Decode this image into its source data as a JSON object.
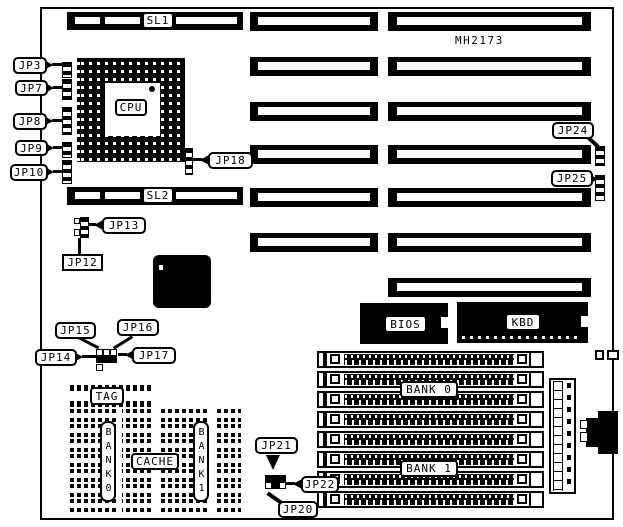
{
  "board": {
    "model": "MH2173"
  },
  "slots": {
    "sl1": "SL1",
    "sl2": "SL2"
  },
  "cpu": {
    "label": "CPU"
  },
  "chips": {
    "bios": "BIOS",
    "kbd": "KBD"
  },
  "cache": {
    "tag": "TAG",
    "cache": "CACHE",
    "bank0": "BANK0",
    "bank1": "BANK1"
  },
  "memory": {
    "bank0": "BANK 0",
    "bank1": "BANK 1"
  },
  "jumpers": {
    "jp3": "JP3",
    "jp7": "JP7",
    "jp8": "JP8",
    "jp9": "JP9",
    "jp10": "JP10",
    "jp12": "JP12",
    "jp13": "JP13",
    "jp14": "JP14",
    "jp15": "JP15",
    "jp16": "JP16",
    "jp17": "JP17",
    "jp18": "JP18",
    "jp20": "JP20",
    "jp21": "JP21",
    "jp22": "JP22",
    "jp24": "JP24",
    "jp25": "JP25"
  },
  "colors": {
    "ink": "#000000",
    "paper": "#ffffff"
  }
}
